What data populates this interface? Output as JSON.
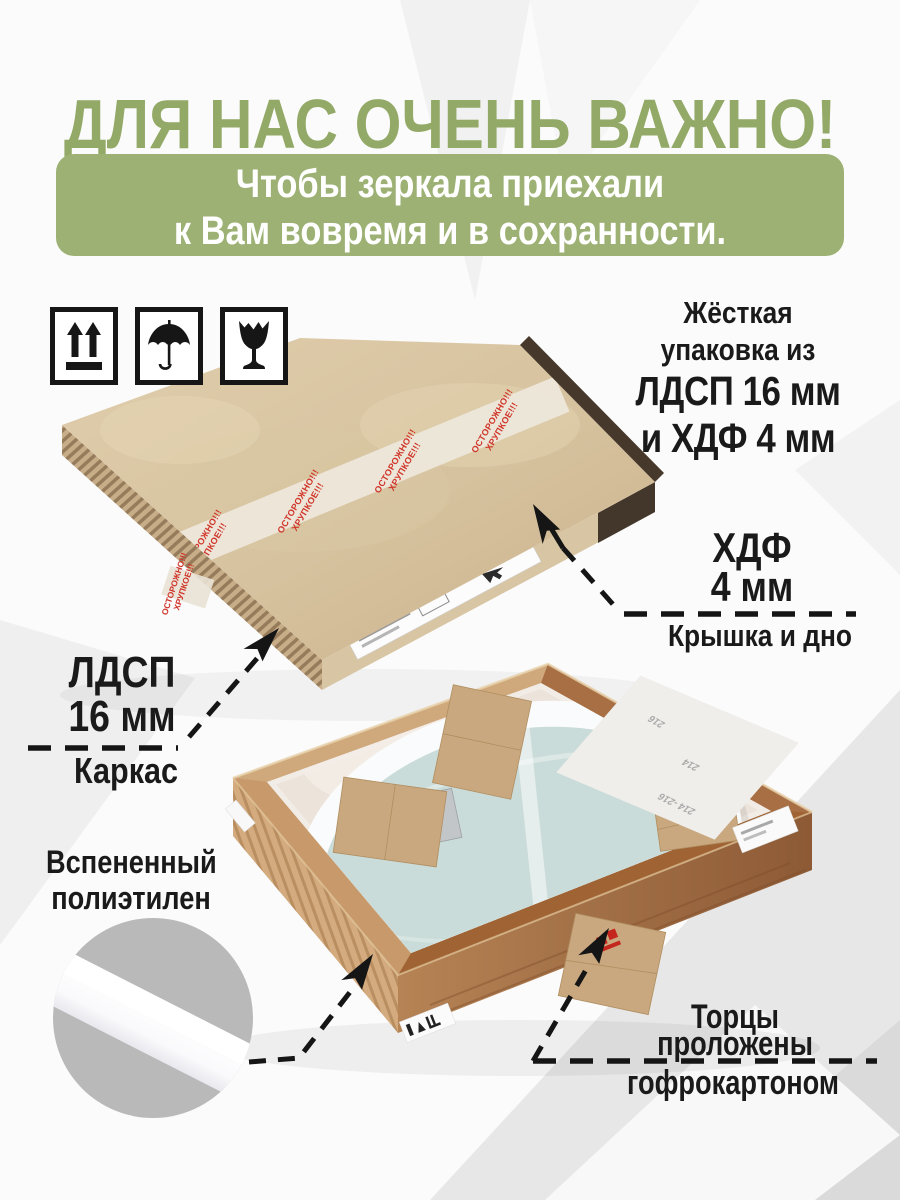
{
  "header": {
    "title": "ДЛЯ НАС ОЧЕНЬ ВАЖНО!",
    "banner_line1": "Чтобы зеркала приехали",
    "banner_line2": "к Вам вовремя и в сохранности."
  },
  "handling_icons": {
    "icon1": "this-way-up-icon",
    "icon2": "keep-dry-umbrella-icon",
    "icon3": "fragile-broken-glass-icon"
  },
  "packaging_note": {
    "line1": "Жёсткая",
    "line2": "упаковка из",
    "line3": "ЛДСП 16 мм",
    "line4": "и ХДФ 4 мм"
  },
  "labels": {
    "hdf": {
      "material": "ХДФ",
      "thickness": "4 мм",
      "part": "Крышка и дно"
    },
    "ldsp": {
      "material": "ЛДСП",
      "thickness": "16 мм",
      "part": "Каркас"
    },
    "foam": {
      "line1": "Вспененный",
      "line2": "полиэтилен"
    },
    "edges": {
      "line1": "Торцы",
      "line2": "проложены",
      "line3": "гофрокартоном"
    }
  },
  "photo1": {
    "tape_line1": "ОСТОРОЖНО!!!",
    "tape_line2": "ХРУПКОЕ!!!"
  },
  "photo2": {
    "sheet_markings": [
      "216",
      "214",
      "214 -216"
    ]
  },
  "colors": {
    "title_green": "#93a967",
    "banner_green": "#9cb173",
    "tape_red": "#d03529",
    "kraft": "#d9c5a2",
    "wood_frame": "#a97145",
    "mirror_glass": "#cadcd9",
    "foam_white": "#f4f5f7",
    "inset_gray": "#b9b9b9",
    "text_black": "#1a1a1a"
  }
}
